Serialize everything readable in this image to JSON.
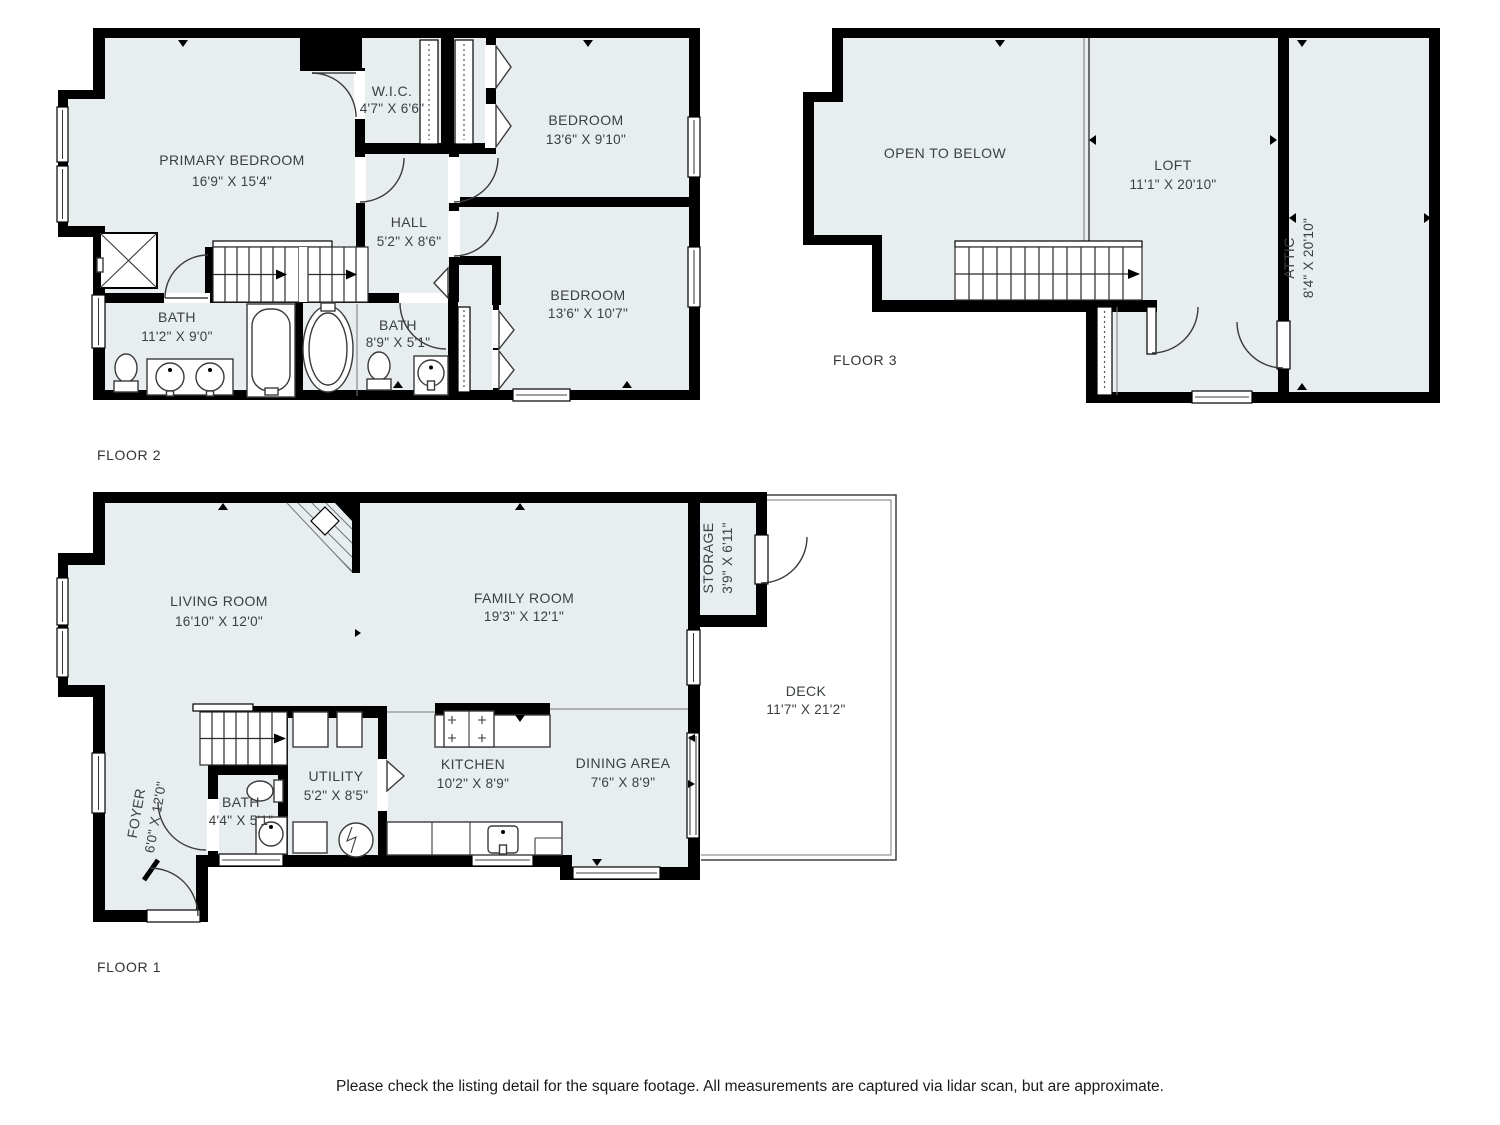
{
  "disclaimer": "Please check the listing detail for the square footage. All measurements are captured via lidar scan, but are approximate.",
  "colors": {
    "floor_fill": "#e8edf0",
    "wall": "#000000"
  },
  "floors": {
    "f1": {
      "label": "FLOOR 1",
      "rooms": {
        "living": {
          "name": "LIVING ROOM",
          "dims": "16'10\" X 12'0\""
        },
        "family": {
          "name": "FAMILY ROOM",
          "dims": "19'3\" X 12'1\""
        },
        "storage": {
          "name": "STORAGE",
          "dims": "3'9\" X 6'11\""
        },
        "deck": {
          "name": "DECK",
          "dims": "11'7\" X 21'2\""
        },
        "dining": {
          "name": "DINING AREA",
          "dims": "7'6\" X 8'9\""
        },
        "kitchen": {
          "name": "KITCHEN",
          "dims": "10'2\" X 8'9\""
        },
        "utility": {
          "name": "UTILITY",
          "dims": "5'2\" X 8'5\""
        },
        "bath": {
          "name": "BATH",
          "dims": "4'4\" X 5'1\""
        },
        "foyer": {
          "name": "FOYER",
          "dims": "6'0\" X 12'0\""
        }
      }
    },
    "f2": {
      "label": "FLOOR 2",
      "rooms": {
        "primary": {
          "name": "PRIMARY BEDROOM",
          "dims": "16'9\" X 15'4\""
        },
        "wic": {
          "name": "W.I.C.",
          "dims": "4'7\" X 6'6\""
        },
        "bedroom1": {
          "name": "BEDROOM",
          "dims": "13'6\" X 9'10\""
        },
        "hall": {
          "name": "HALL",
          "dims": "5'2\" X 8'6\""
        },
        "bath1": {
          "name": "BATH",
          "dims": "11'2\" X 9'0\""
        },
        "bath2": {
          "name": "BATH",
          "dims": "8'9\" X 5'1\""
        },
        "bedroom2": {
          "name": "BEDROOM",
          "dims": "13'6\" X 10'7\""
        }
      }
    },
    "f3": {
      "label": "FLOOR 3",
      "rooms": {
        "open": {
          "name": "OPEN TO BELOW"
        },
        "loft": {
          "name": "LOFT",
          "dims": "11'1\" X 20'10\""
        },
        "attic": {
          "name": "ATTIC",
          "dims": "8'4\" X 20'10\""
        }
      }
    }
  }
}
